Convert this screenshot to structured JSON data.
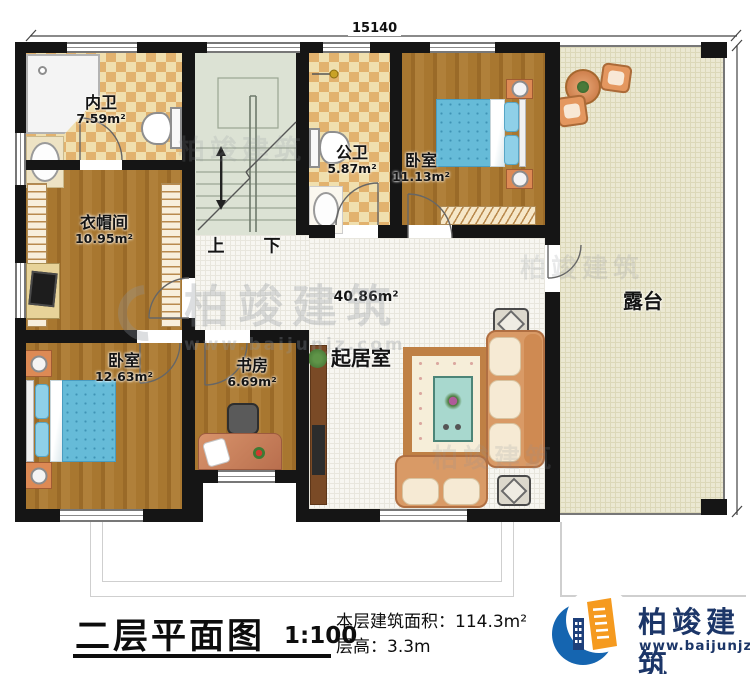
{
  "dimensions": {
    "top": "15140",
    "right": "11870"
  },
  "rooms": {
    "neiwei": {
      "name": "内卫",
      "area": "7.59m²"
    },
    "gongwei": {
      "name": "公卫",
      "area": "5.87m²"
    },
    "bedroom_top": {
      "name": "卧室",
      "area": "11.13m²"
    },
    "cloakroom": {
      "name": "衣帽间",
      "area": "10.95m²"
    },
    "bedroom_left": {
      "name": "卧室",
      "area": "12.63m²"
    },
    "study": {
      "name": "书房",
      "area": "6.69m²"
    },
    "living": {
      "name": "起居室",
      "area": "40.86m²"
    },
    "terrace": {
      "name": "露台"
    }
  },
  "stairs": {
    "up": "上",
    "down": "下"
  },
  "footer": {
    "title": "二层平面图",
    "scale": "1:100",
    "area_label": "本层建筑面积：",
    "area_value": "114.3m²",
    "height_label": "层高：",
    "height_value": "3.3m"
  },
  "logo": {
    "name": "柏竣建筑",
    "url": "www.baijunjz.com"
  },
  "watermark": {
    "text": "柏竣建筑",
    "url": "www.baijunjz.com"
  },
  "colors": {
    "wall": "#151515",
    "wood": "#a5762f",
    "checker": "#e2b26e",
    "bed_blue": "#66bbd8",
    "sofa": "#d99a66",
    "terrace_floor": "#ebe8d2",
    "logo_blue": "#1565b0",
    "logo_orange": "#f59a1f",
    "logo_navy": "#1c3668"
  }
}
